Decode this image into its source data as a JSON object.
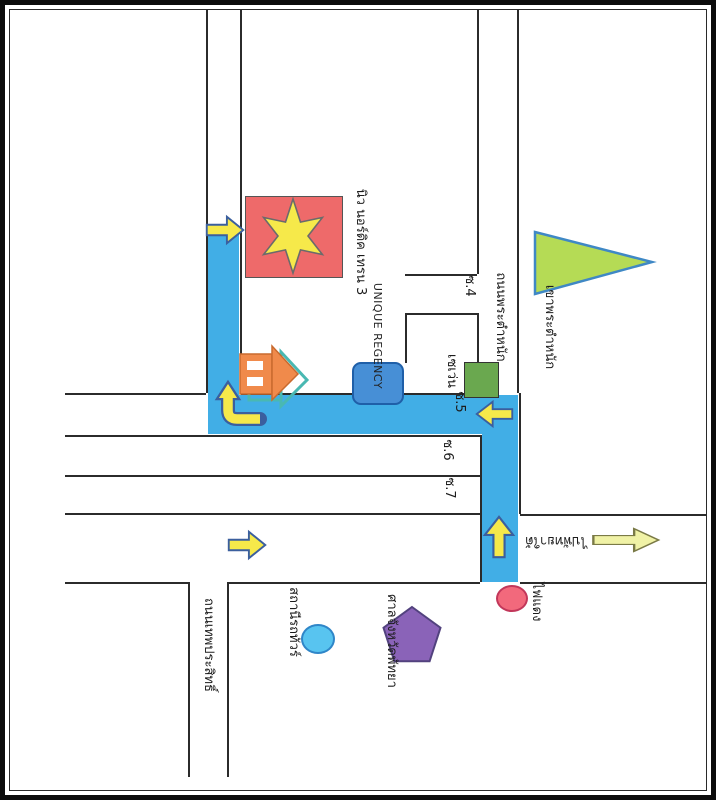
{
  "map": {
    "labels": {
      "destination": "นิว นอร์ดิค เทรน 3",
      "unique_regency": "UNIQUE REGENCY",
      "seven_eleven": "เซเว่น",
      "soi4": "ซ.4",
      "soi5": "ซ.5",
      "soi6": "ซ.6",
      "soi7": "ซ.7",
      "phra_tamnak_road": "ถนนพระตำหนัก",
      "thepprasit_road": "ถนนเทพประสิทธิ์",
      "hill": "เขาพระตำหนัก",
      "to_south_pattaya": "ไปพัทยาใต้",
      "traffic_light": "ไฟแดง",
      "bus_station": "สถานีรถทัวร์",
      "court": "ศาลจังหวัดพัทยา"
    },
    "markers": {
      "destination_marker": "red rectangle with yellow six-pointed star",
      "hill_marker": "green triangle",
      "seven_eleven_marker": "green rectangle",
      "unique_regency_marker": "blue rounded rectangle",
      "bus_station_marker": "blue ellipse",
      "court_marker": "purple pentagon",
      "traffic_light_marker": "red circle",
      "house_marker": "orange house icon"
    },
    "colors": {
      "route_blue": "#41aee6",
      "building_red": "#ee6a6a",
      "star_yellow": "#f6e94a",
      "arrow_yellow": "#f6e94a",
      "arrow_outline": "#3b5f9e",
      "pale_arrow": "#f0f2a6",
      "hill_green": "#b5db55",
      "seven_green": "#6aa84f",
      "court_purple": "#8a63b8",
      "station_blue": "#58c4f0",
      "traffic_red": "#f2697c",
      "building_blue": "#478fd6",
      "house_orange": "#f08a4b",
      "road_line": "#2b2b2b"
    }
  }
}
